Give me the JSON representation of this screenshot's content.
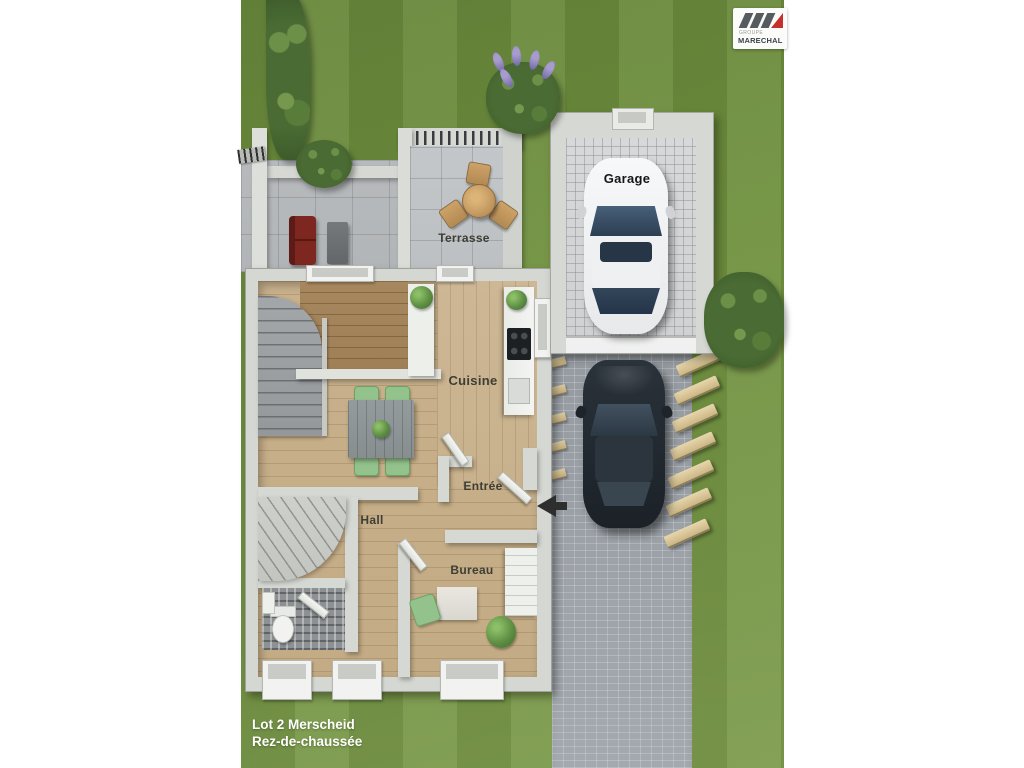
{
  "caption": {
    "line1": "Lot 2 Merscheid",
    "line2": "Rez-de-chaussée"
  },
  "rooms": {
    "terrasse": "Terrasse",
    "garage": "Garage",
    "cuisine": "Cuisine",
    "entree": "Entrée",
    "hall": "Hall",
    "bureau": "Bureau"
  },
  "logo": {
    "group": "GROUPE",
    "name": "MARECHAL"
  },
  "colors": {
    "lawn_green": "#71923f",
    "driveway_grey": "#9aa0a5",
    "wall_grey": "#d5d8d3",
    "wood_light": "#c8b18c",
    "wood_dark": "#a7875e",
    "logo_red": "#c5302c",
    "sofa_red": "#7e2620"
  }
}
